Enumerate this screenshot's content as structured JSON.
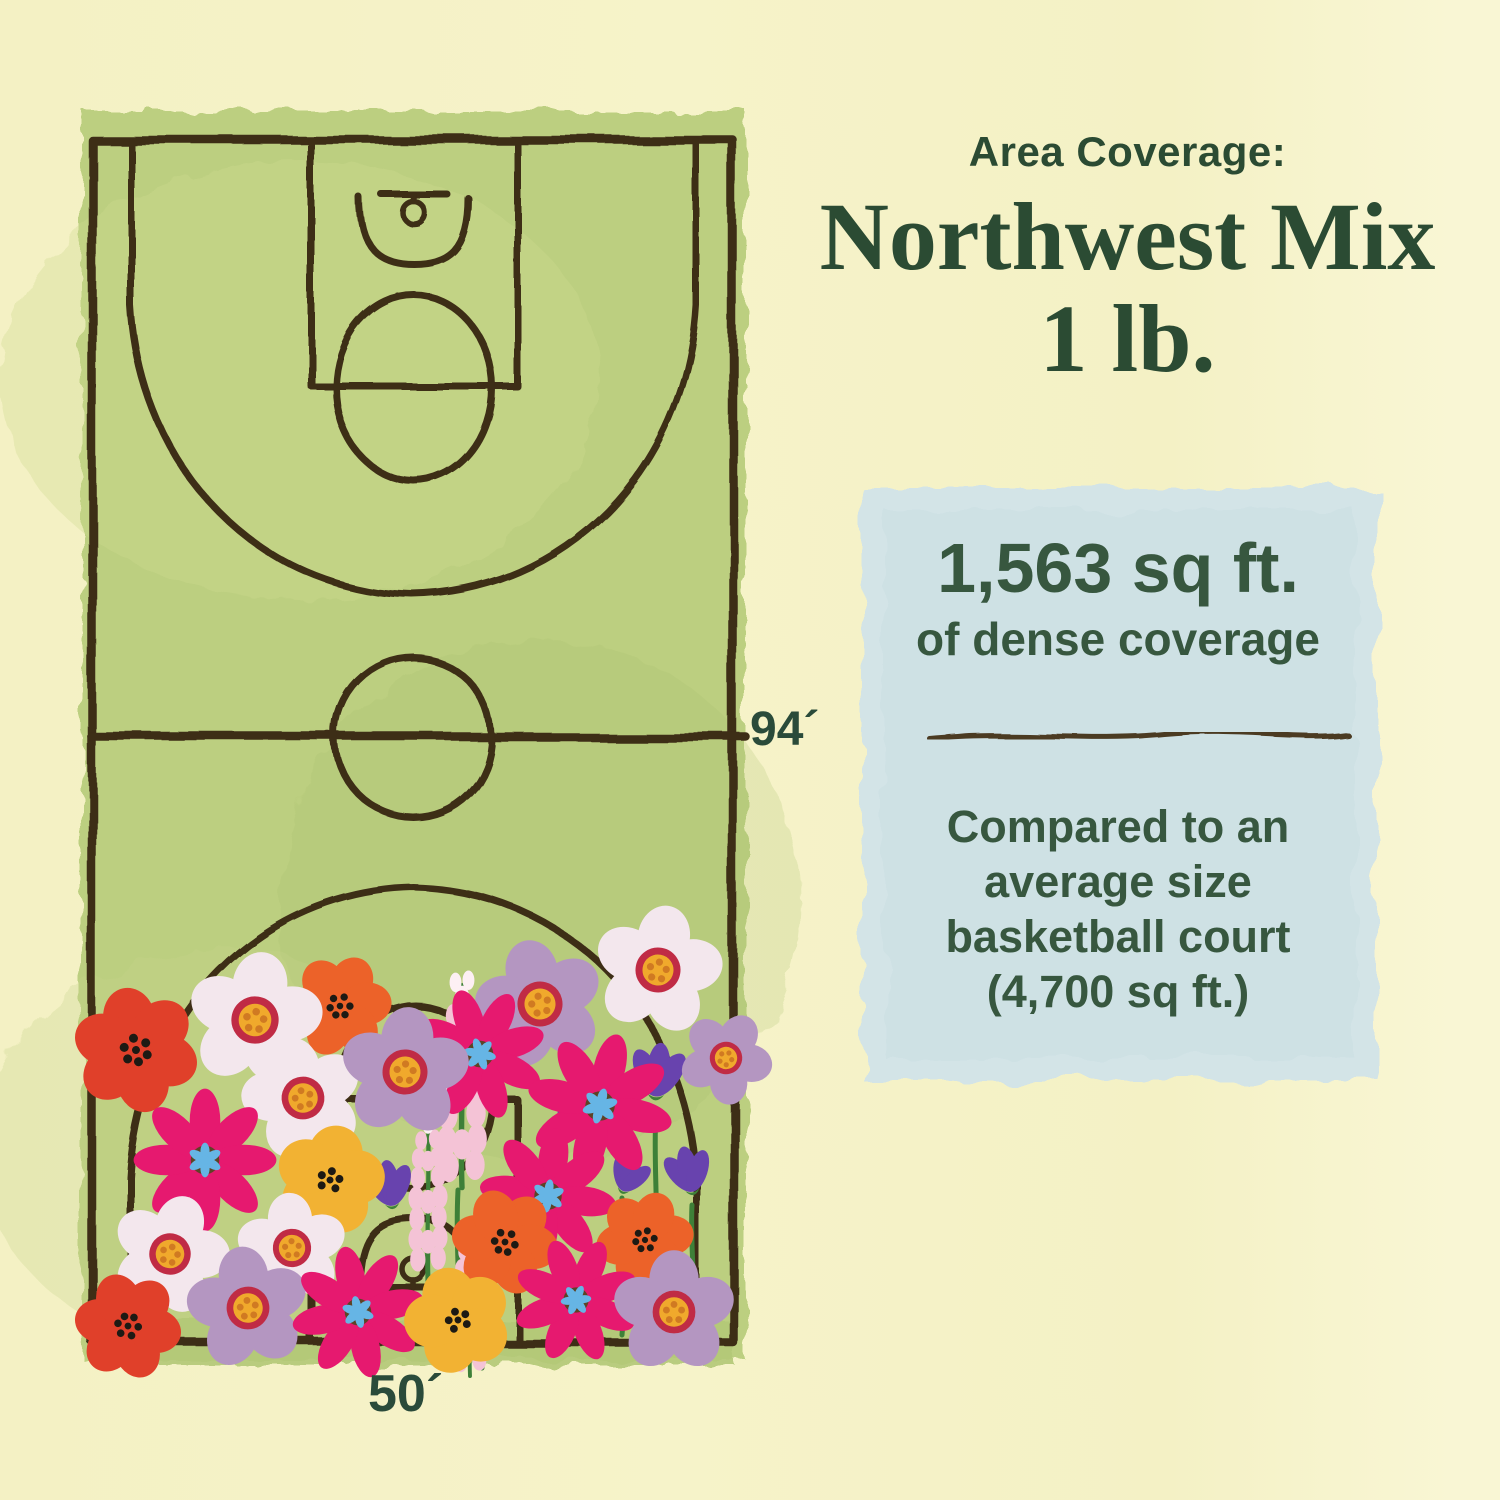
{
  "palette": {
    "page-bg": "#f6f3c9",
    "court-green": "#bccf80",
    "court-line": "#3e2d17",
    "card-blue": "#d3e4e7",
    "ink-green": "#2b4b33",
    "ink-green-soft": "#37573f",
    "flower-red": "#e0402a",
    "flower-orange": "#ec6229",
    "flower-magenta": "#e6196f",
    "flower-white": "#f3e7ed",
    "flower-mauve": "#b496c1",
    "flower-yellow": "#f2b233",
    "flower-purple": "#6843ae",
    "flower-pink": "#f4c3d6",
    "center-blue": "#66b5e5",
    "center-yellow": "#f0a92c",
    "center-ring": "#c02b45",
    "stem-green": "#3e8038"
  },
  "header": {
    "eyebrow": "Area Coverage:",
    "title_line1": "Northwest Mix",
    "title_line2": "1 lb."
  },
  "court": {
    "height_label": "94´",
    "width_label": "50´"
  },
  "coverage_card": {
    "headline": "1,563 sq ft.",
    "subhead": "of dense coverage",
    "comparison_lines": [
      "Compared to an",
      "average size",
      "basketball court",
      "(4,700 sq ft.)"
    ]
  }
}
